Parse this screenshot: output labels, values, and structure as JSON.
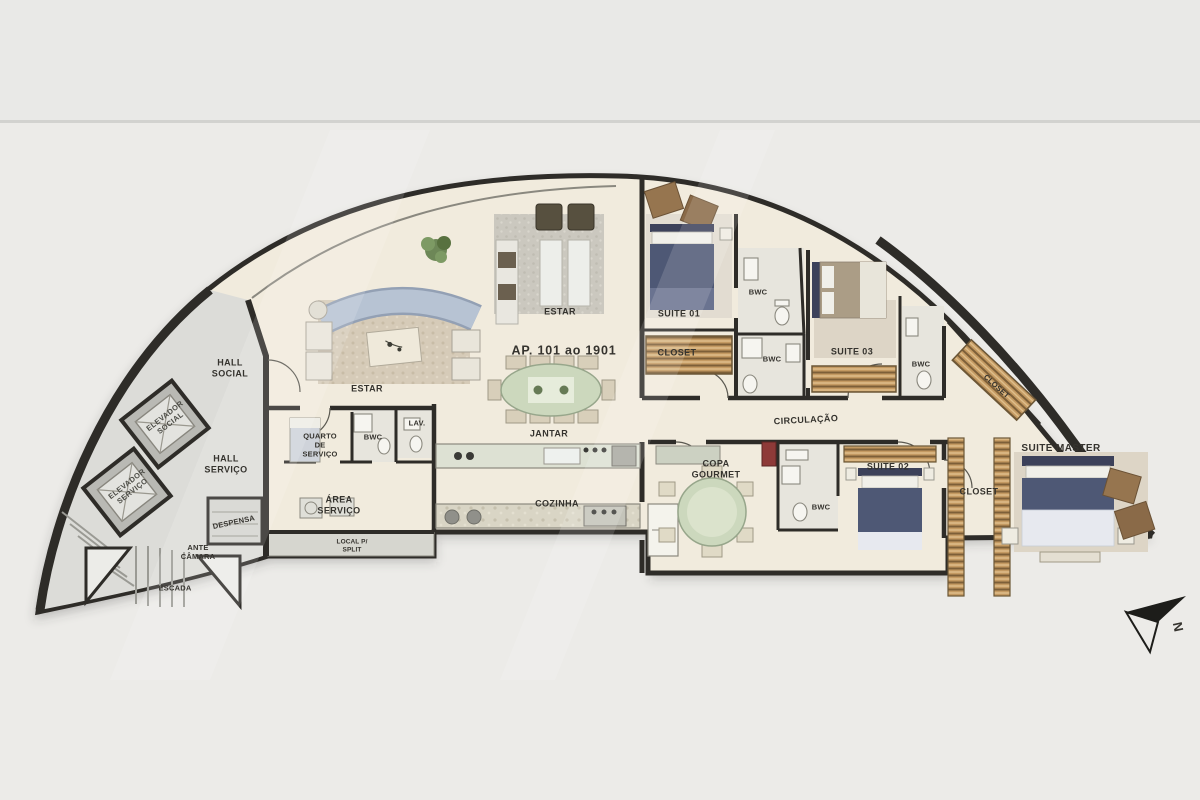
{
  "meta": {
    "type": "architectural floor plan",
    "apartment": "AP. 101 ao 1901"
  },
  "palette": {
    "page_bg": "#ecebe8",
    "band_bg": "#e9e9e7",
    "divider": "#d2d2cf",
    "wall": "#2e2c28",
    "floor": "#f1ebdd",
    "common": "#dcdcd8",
    "label": "#35332e",
    "sofa": "#b7c3d3",
    "bed": "#4e5875",
    "pillow": "#f0efe9",
    "wardrobe": "#c49a62",
    "table_green": "#ccd8bd",
    "counter": "#dde1d3",
    "bath": "#e7e5dd"
  },
  "labels": {
    "hall_social": "HALL\nSOCIAL",
    "elevador_social": "ELEVADOR\nSOCIAL",
    "elevador_servico": "ELEVADOR\nSERVIÇO",
    "hall_servico": "HALL\nSERVIÇO",
    "despensa": "DESPENSA",
    "ante_camara": "ANTE\nCÂMARA",
    "escada": "ESCADA",
    "estar_1": "ESTAR",
    "estar_2": "ESTAR",
    "apartment_title": "AP. 101 ao 1901",
    "jantar": "JANTAR",
    "lav": "LAV.",
    "quarto_servico": "QUARTO\nDE\nSERVIÇO",
    "bwc_servico": "BWC",
    "area_servico": "ÁREA\nSERVIÇO",
    "cozinha": "COZINHA",
    "local_split": "LOCAL P/\nSPLIT",
    "suite_01": "SUITE 01",
    "closet_suite01": "CLOSET",
    "bwc_1": "BWC",
    "bwc_2": "BWC",
    "suite_03": "SUITE 03",
    "bwc_suite03": "BWC",
    "closet_suite03": "CLOSET",
    "circulacao": "CIRCULAÇÃO",
    "copa_gourmet": "COPA\nGOURMET",
    "bwc_suite02": "BWC",
    "suite_02": "SUITE 02",
    "closet_master": "CLOSET",
    "suite_master": "SUITE MASTER",
    "north": "N"
  }
}
